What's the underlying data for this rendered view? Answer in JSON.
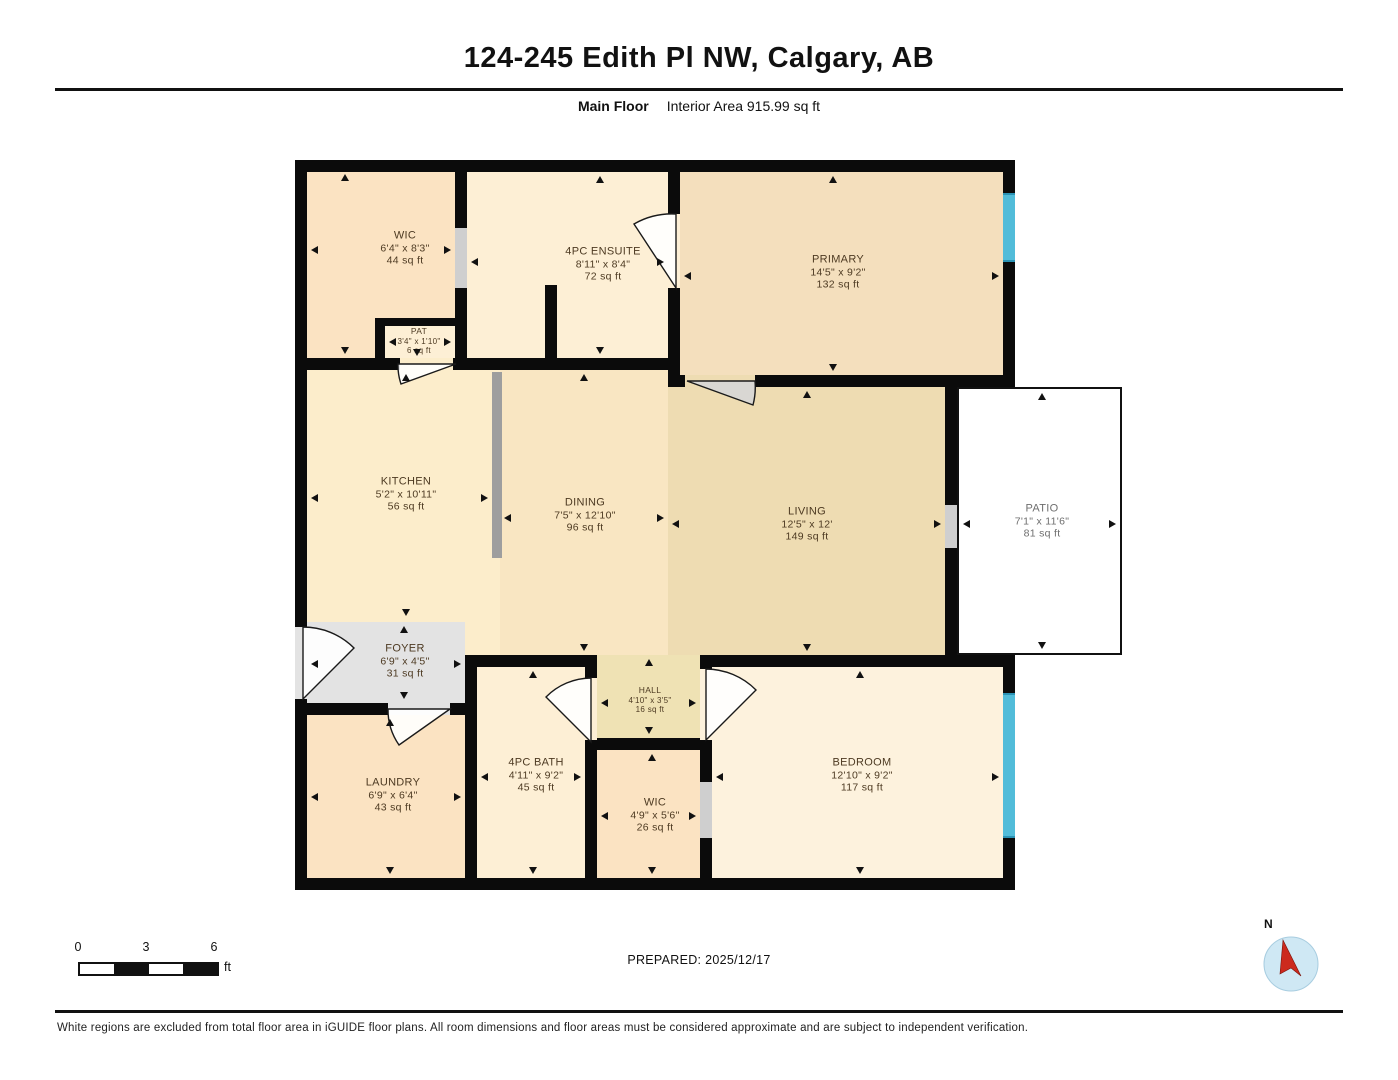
{
  "header": {
    "title": "124-245 Edith Pl NW, Calgary, AB",
    "floor_label": "Main Floor",
    "interior_area": "Interior Area 915.99 sq ft"
  },
  "rooms": [
    {
      "id": "wic-top",
      "name": "WIC",
      "dims": "6'4\" x 8'3\"",
      "area": "44 sq ft"
    },
    {
      "id": "pat",
      "name": "PAT",
      "dims": "3'4\" x 1'10\"",
      "area": "6 sq ft"
    },
    {
      "id": "ensuite",
      "name": "4PC ENSUITE",
      "dims": "8'11\" x 8'4\"",
      "area": "72 sq ft"
    },
    {
      "id": "primary",
      "name": "PRIMARY",
      "dims": "14'5\" x 9'2\"",
      "area": "132 sq ft"
    },
    {
      "id": "kitchen",
      "name": "KITCHEN",
      "dims": "5'2\" x 10'11\"",
      "area": "56 sq ft"
    },
    {
      "id": "dining",
      "name": "DINING",
      "dims": "7'5\" x 12'10\"",
      "area": "96 sq ft"
    },
    {
      "id": "living",
      "name": "LIVING",
      "dims": "12'5\" x 12'",
      "area": "149 sq ft"
    },
    {
      "id": "patio",
      "name": "PATIO",
      "dims": "7'1\" x 11'6\"",
      "area": "81 sq ft"
    },
    {
      "id": "foyer",
      "name": "FOYER",
      "dims": "6'9\" x 4'5\"",
      "area": "31 sq ft"
    },
    {
      "id": "hall",
      "name": "HALL",
      "dims": "4'10\" x 3'5\"",
      "area": "16 sq ft"
    },
    {
      "id": "laundry",
      "name": "LAUNDRY",
      "dims": "6'9\" x 6'4\"",
      "area": "43 sq ft"
    },
    {
      "id": "bath",
      "name": "4PC BATH",
      "dims": "4'11\" x 9'2\"",
      "area": "45 sq ft"
    },
    {
      "id": "wic-bottom",
      "name": "WIC",
      "dims": "4'9\" x 5'6\"",
      "area": "26 sq ft"
    },
    {
      "id": "bedroom",
      "name": "BEDROOM",
      "dims": "12'10\" x 9'2\"",
      "area": "117 sq ft"
    }
  ],
  "scale_bar": {
    "tick0": "0",
    "tick1": "3",
    "tick2": "6",
    "unit": "ft"
  },
  "prepared": "PREPARED: 2025/12/17",
  "compass": {
    "north_label": "N"
  },
  "footer": "White regions are excluded from total floor area in iGUIDE floor plans. All room dimensions and floor areas must be considered approximate and are subject to independent verification.",
  "colors": {
    "wall": "#0b0b0b",
    "room_peach": "#fbe3c2",
    "room_cream": "#fdefd5",
    "room_tan": "#f4dfbd",
    "room_kitchen": "#fcedcb",
    "room_dining": "#f9e6c2",
    "room_living": "#eedcb2",
    "room_hall": "#efe2b4",
    "room_bedroom": "#fdf2dd",
    "foyer_gray": "#e3e3e3",
    "door_gray": "#cfcfcf",
    "window_blue": "#52bcd9",
    "compass_red": "#cc2a1e"
  }
}
